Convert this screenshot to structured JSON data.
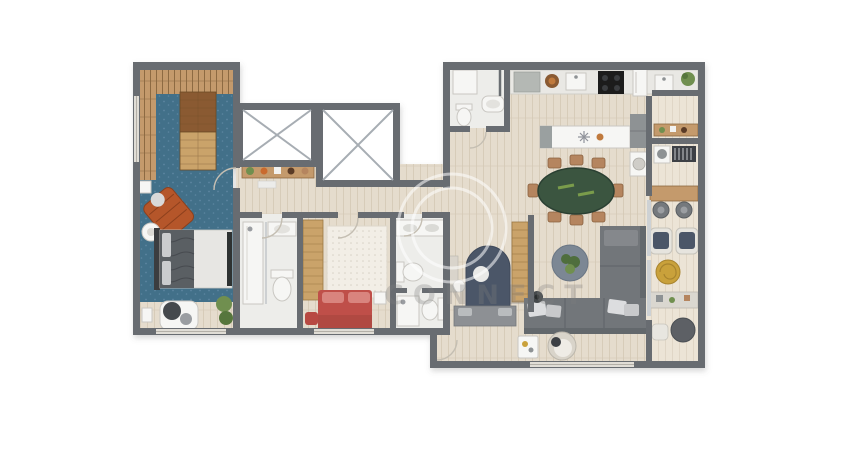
{
  "title": "apartment-floor-plan",
  "watermark": {
    "text": "CONNECT",
    "logo": "circle-ring"
  },
  "palette": {
    "wall": "#686c71",
    "wood_floor": "#e5dccd",
    "wood_grain": "#d6cab7",
    "wood_pale": "#ece4d6",
    "wood_pale_grain": "#ddd3c2",
    "deck": "#c49a6c",
    "deck_line": "#8d6a43",
    "pool_blue": "#427089",
    "pool_speckle": "#5b85a0",
    "tile": "#ededea",
    "rug_cream": "#f2eee6",
    "rug_dot": "#d8d2c6",
    "red_bed": "#bf4f48",
    "navy": "#4b5668",
    "sofa": "#72767a",
    "sofa_edge": "#64686c",
    "table_green": "#3a5440",
    "chair_tan": "#b5855f",
    "gold": "#c9a13b",
    "plant": "#6f8f4f",
    "white_fixture": "#f6f6f4",
    "counter": "#e9e8e4",
    "appliance_dark": "#1b1d1f",
    "cabinet_gray": "#8e9294",
    "wardrobe": "#caa36b",
    "glass_x": "#a7adb3"
  },
  "rooms": [
    {
      "name": "terrace-deck",
      "floor": "wood-deck-and-blue"
    },
    {
      "name": "master-bedroom",
      "floor": "blue-carpet"
    },
    {
      "name": "master-bathroom",
      "floor": "tile"
    },
    {
      "name": "hallway",
      "floor": "wood"
    },
    {
      "name": "bedroom-2",
      "floor": "wood-with-rug"
    },
    {
      "name": "bathroom-2",
      "floor": "tile"
    },
    {
      "name": "bedroom-3",
      "floor": "wood"
    },
    {
      "name": "powder-room",
      "floor": "tile"
    },
    {
      "name": "kitchen",
      "floor": "wood"
    },
    {
      "name": "dining-area",
      "floor": "wood"
    },
    {
      "name": "living-room",
      "floor": "wood"
    },
    {
      "name": "gourmet-balcony",
      "floor": "pale-wood"
    },
    {
      "name": "elevator-shafts",
      "count": 2
    }
  ],
  "furniture": [
    "buffet-table",
    "lounge-chair",
    "double-bed",
    "corner-armchair",
    "console-shelf",
    "shower",
    "toilet",
    "sink-counter",
    "wardrobe",
    "red-double-bed",
    "area-rug",
    "navy-arched-bed",
    "daybed-bench",
    "desk",
    "kitchen-counter",
    "cooktop",
    "kitchen-sink",
    "fridge",
    "kitchen-island",
    "oval-dining-table",
    "dining-chairs-x8",
    "l-shaped-sofa",
    "round-rug-with-plant",
    "armchair",
    "side-table",
    "bar-counter",
    "bar-stools-x2",
    "balcony-armchairs-x2",
    "gold-pouf",
    "console-table",
    "round-coffee-table",
    "washer",
    "ac-vent",
    "plants"
  ]
}
